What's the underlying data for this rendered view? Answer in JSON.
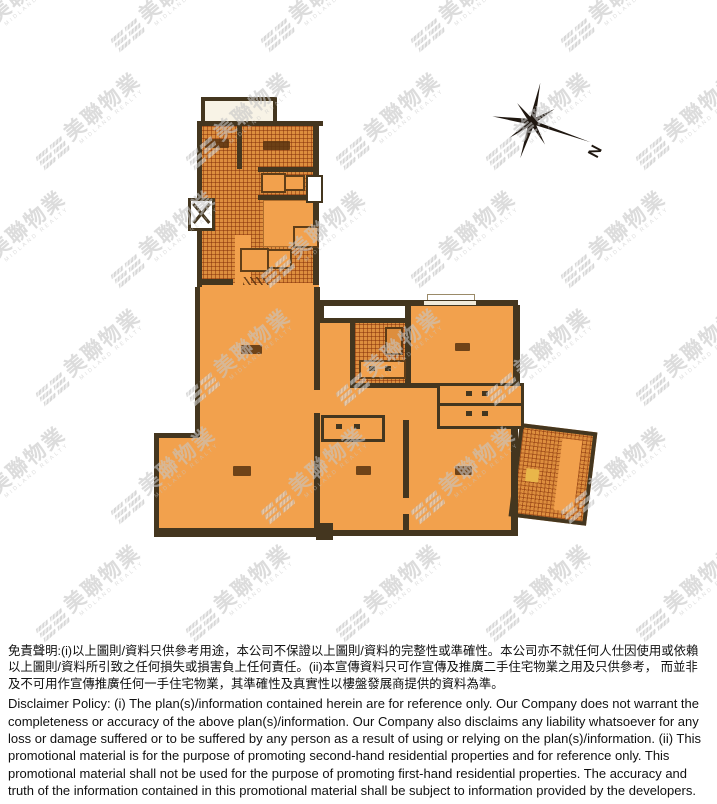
{
  "watermark": {
    "text": "美聯物業",
    "subtext": "MIDLAND REALTY"
  },
  "compass": {
    "label": "N"
  },
  "disclaimer": {
    "chinese": "免責聲明:(i)以上圖則/資料只供參考用途，本公司不保證以上圖則/資料的完整性或準確性。本公司亦不就任何人仕因使用或依賴以上圖則/資料所引致之任何損失或損害負上任何責任。(ii)本宣傳資料只可作宣傳及推廣二手住宅物業之用及只供參考， 而並非及不可用作宣傳推廣任何一手住宅物業，其準確性及真實性以樓盤發展商提供的資料為準。",
    "english": "Disclaimer Policy: (i) The plan(s)/information contained herein are for reference only. Our Company does not warrant the completeness or accuracy of the above plan(s)/information. Our Company also disclaims any liability whatsoever for any loss or damage suffered or to be suffered by any person as a result of using or relying on the plan(s)/information. (ii) This promotional material is for the purpose of promoting second-hand residential properties and for reference only. This promotional material shall not be used for the purpose of promoting first-hand residential properties. The accuracy and truth of the information contained in this promotional material shall be subject to information provided by the developers."
  },
  "colors": {
    "room_orange": "#f2a14d",
    "hatch_orange": "#dd8e3e",
    "wall_brown": "#44361f",
    "watermark_gray": "#c6c6c6",
    "balcony_white": "#f8f3e6"
  }
}
